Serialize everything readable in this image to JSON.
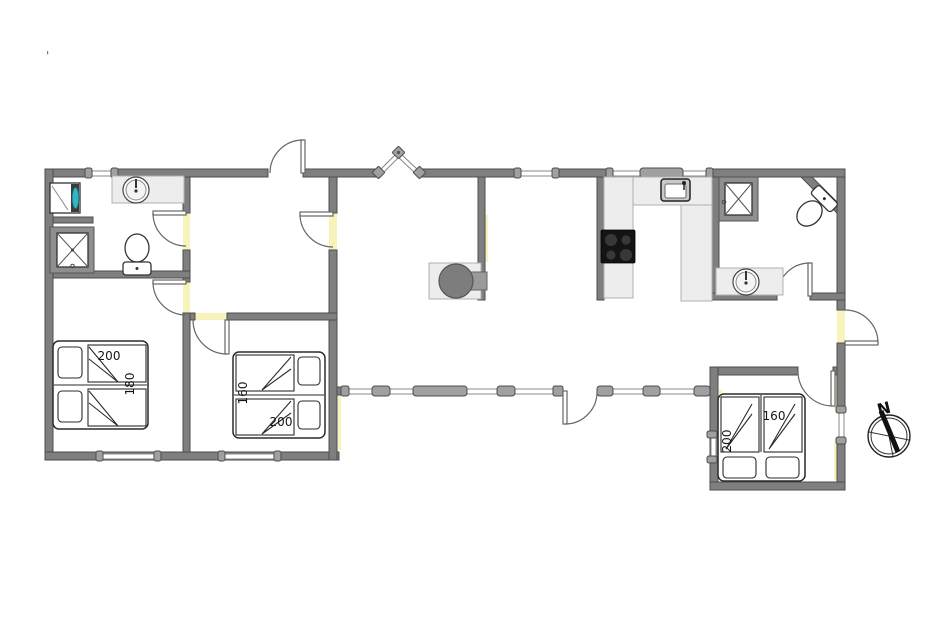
{
  "page": {
    "corner_mark": "'"
  },
  "beds": [
    {
      "name": "double-bed-bedroom-left",
      "length_label": "200",
      "width_label": "180"
    },
    {
      "name": "double-bed-bedroom-middle",
      "width_label": "160",
      "length_label": "200"
    },
    {
      "name": "double-bed-bedroom-right",
      "width_label": "160",
      "length_label": "200"
    }
  ],
  "compass": {
    "north_label": "N"
  },
  "colors": {
    "wall_fill": "#7f7f7f",
    "wall_outline": "#4c4c4c",
    "counter_fill": "#ededed",
    "opening_highlight_yellow": "#f7f3bb",
    "washer_door_teal": "#37b3c4",
    "cooktop_black": "#141414",
    "stove_gray": "#7d7d7d"
  }
}
